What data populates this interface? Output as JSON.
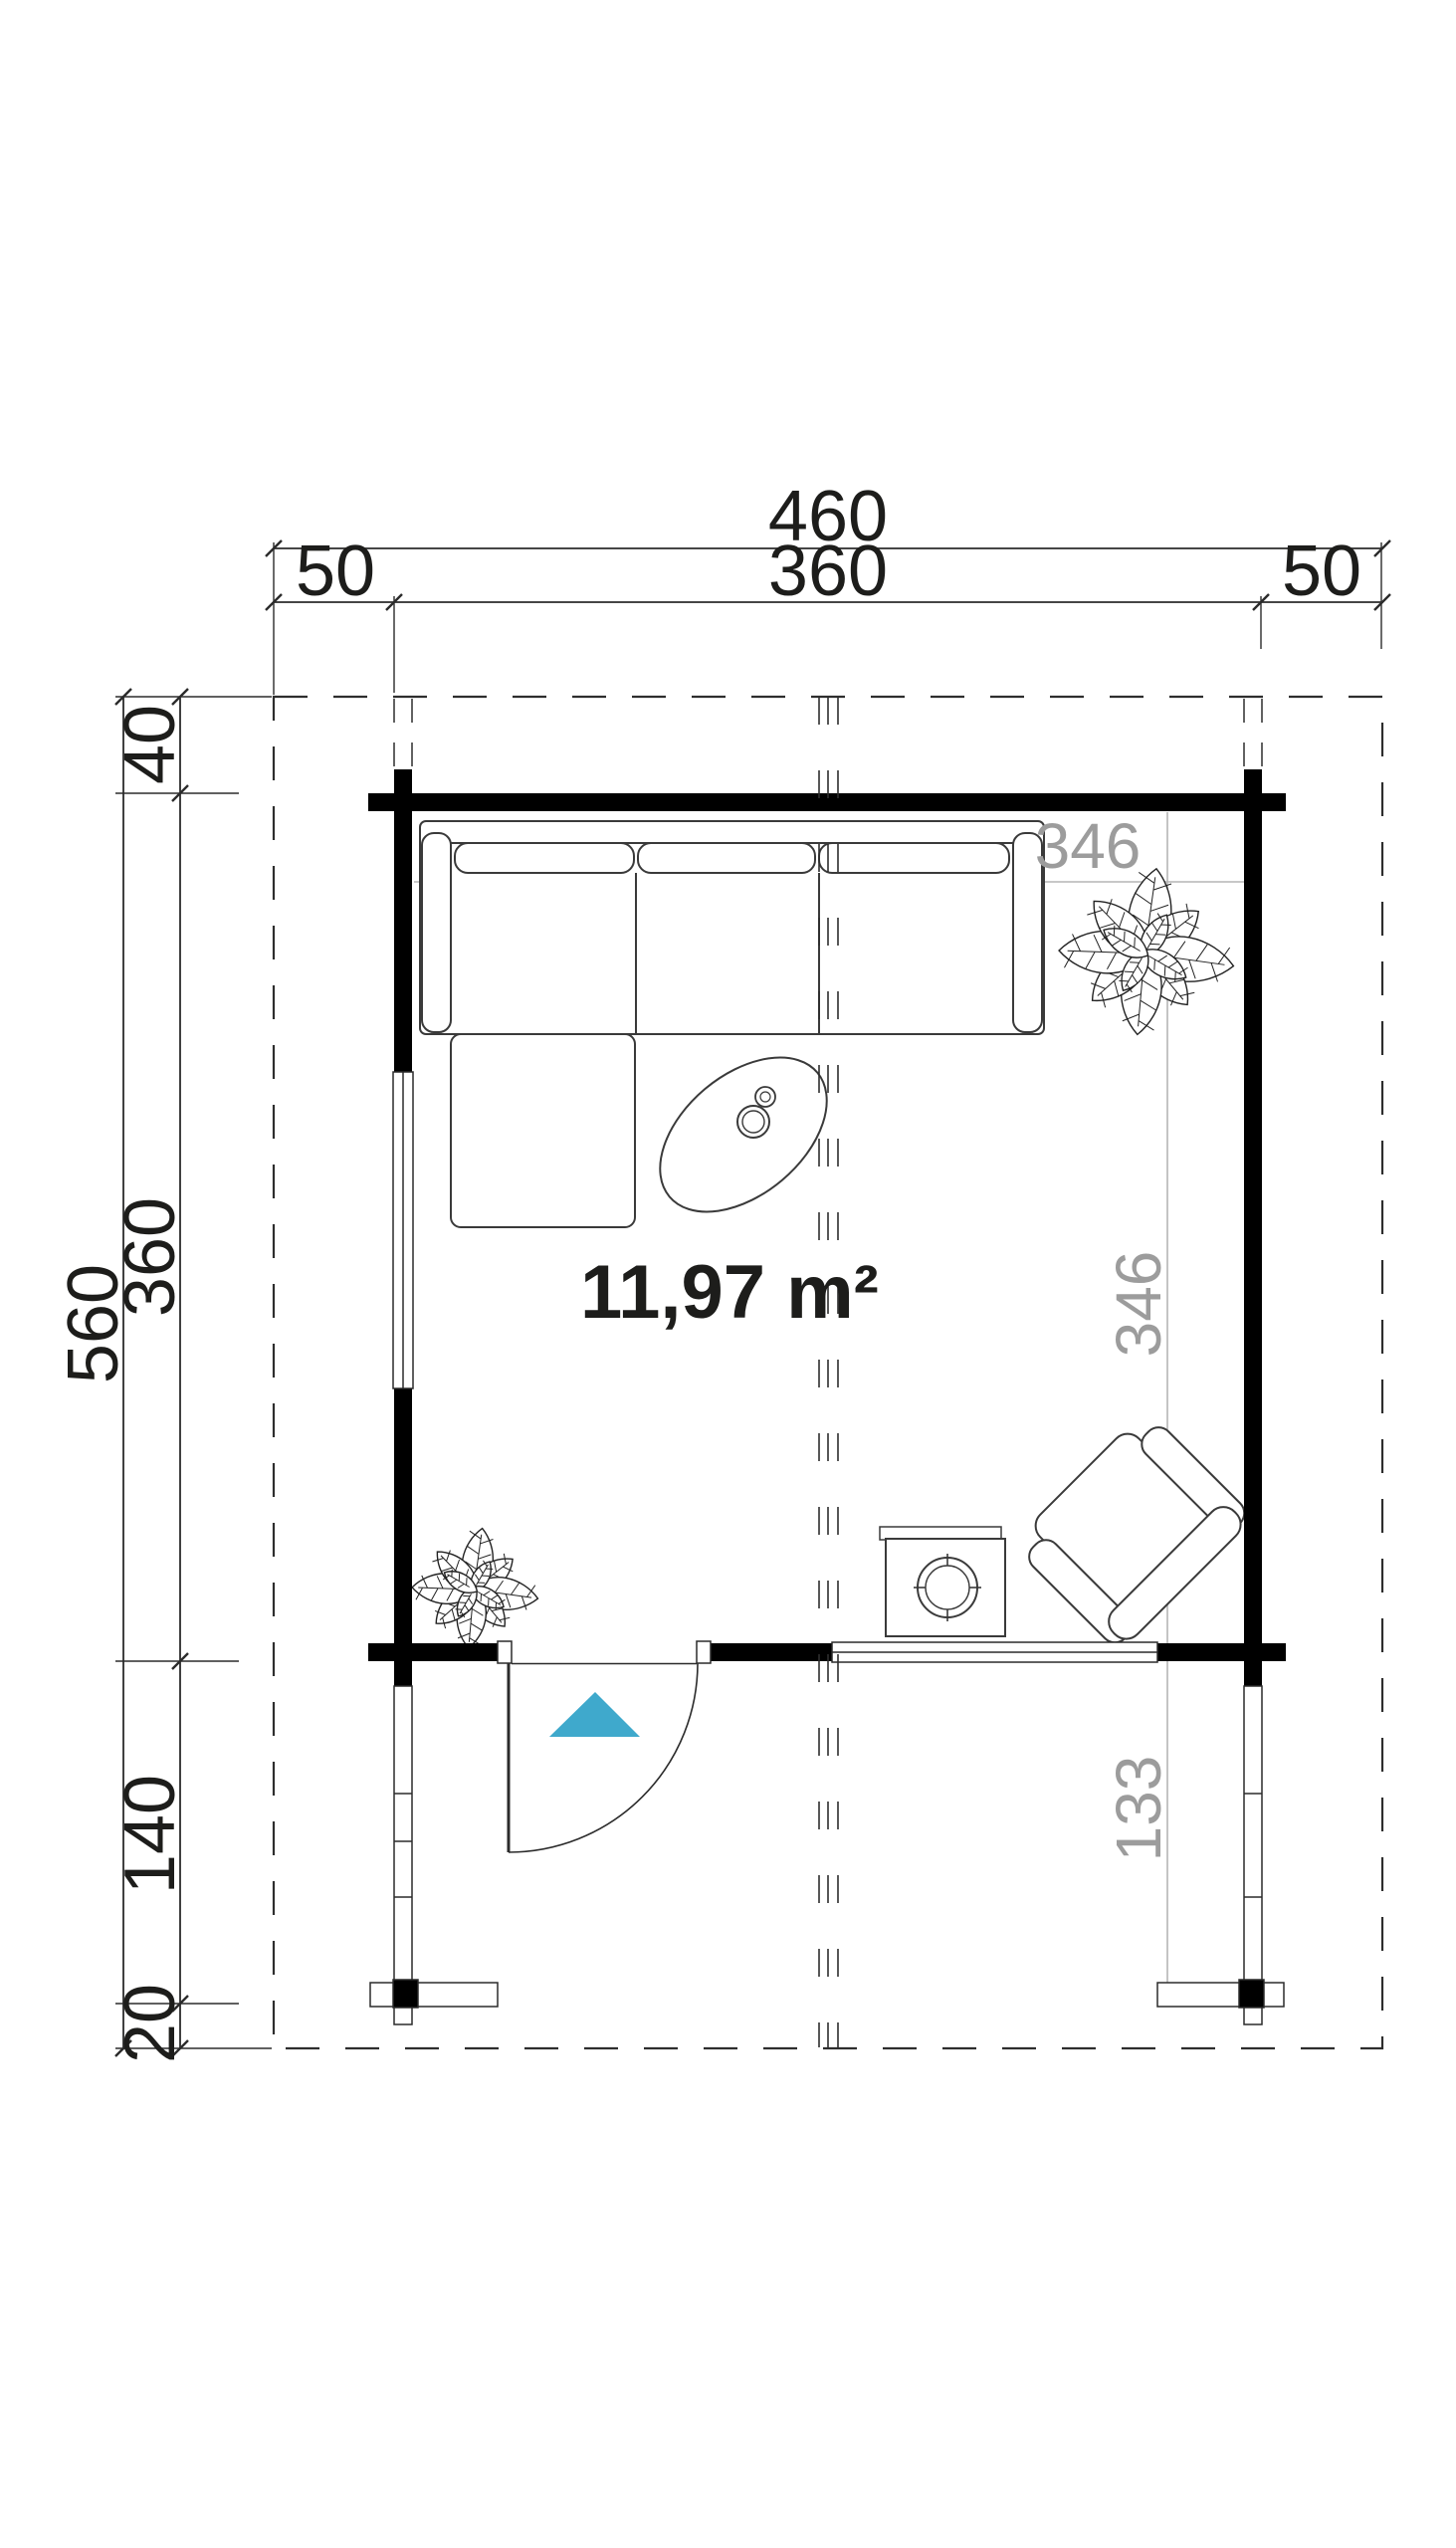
{
  "colors": {
    "arrow": "#3fa9cc",
    "gray_label": "#9c9c9c"
  },
  "dims_top": {
    "total": "460",
    "overhang_left": "50",
    "wall": "360",
    "overhang_right": "50"
  },
  "dims_left": {
    "total": "560",
    "overhang_top": "40",
    "wall": "360",
    "porch": "140",
    "overhang_bottom": "20"
  },
  "interior": {
    "room_width": "346",
    "room_depth": "346",
    "porch_depth": "133"
  },
  "room": {
    "area_label": "11,97 m²"
  }
}
